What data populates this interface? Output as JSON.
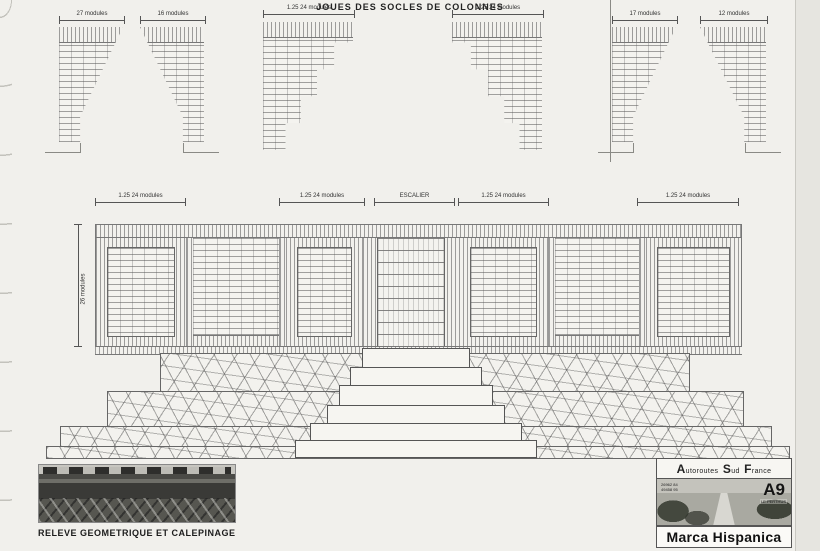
{
  "sheet": {
    "title": "JOUES DES SOCLES DE COLONNES"
  },
  "top_shapes": [
    {
      "dim": "27 modules"
    },
    {
      "dim": "16 modules"
    },
    {
      "dim": "1.25  24 modules"
    },
    {
      "dim": "1.25  24 modules"
    },
    {
      "dim": "17 modules"
    },
    {
      "dim": "12 modules"
    }
  ],
  "elevation": {
    "dims": [
      "1.25  24 modules",
      "1.25  24 modules",
      "1.25  24 modules",
      "1.25  24 modules"
    ],
    "center_label": "ESCALIER",
    "height_dim": "26 modules"
  },
  "footer_left": {
    "caption": "RELEVE GEOMETRIQUE ET CALEPINAGE"
  },
  "footer_right": {
    "company_part1": "Autoroutes",
    "company_part2": "Sud",
    "company_part3": "France",
    "ref_line1": "26962 84",
    "ref_line2": "49458 95",
    "road": "A9",
    "location": "LE PERTHUS",
    "monument": "Marca Hispanica"
  }
}
